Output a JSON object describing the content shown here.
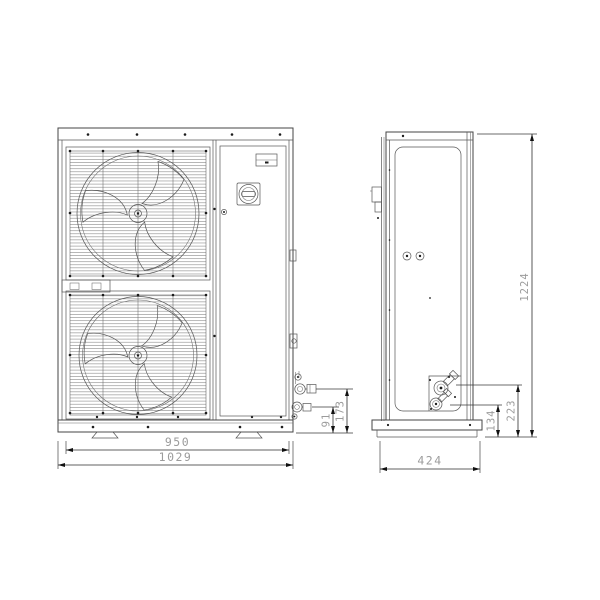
{
  "drawing": {
    "kind": "two-view dimensioned outline drawing",
    "subject": "dual-fan outdoor condensing unit",
    "line_color": "#454545",
    "dim_text_color": "#9b9b9b",
    "background": "#ffffff"
  },
  "dims": {
    "front": {
      "feet_spacing": "950",
      "overall_width": "1029",
      "pipe_connection_low": "91",
      "pipe_connection_high": "173"
    },
    "side": {
      "depth": "424",
      "pipe_connection_low": "134",
      "pipe_connection_high": "223",
      "overall_height": "1224"
    }
  }
}
